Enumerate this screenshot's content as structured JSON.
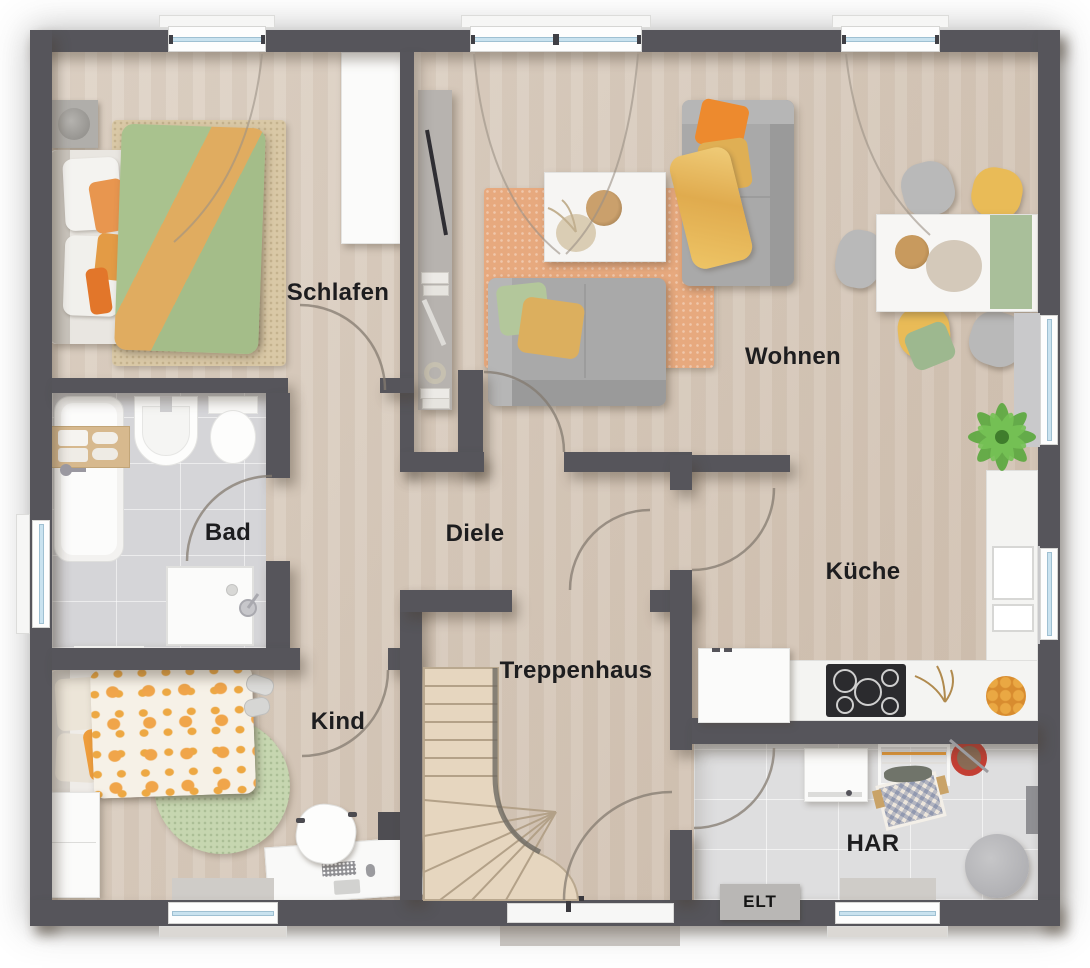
{
  "rooms": [
    {
      "id": "schlafen",
      "label": "Schlafen"
    },
    {
      "id": "wohnen",
      "label": "Wohnen"
    },
    {
      "id": "bad",
      "label": "Bad"
    },
    {
      "id": "diele",
      "label": "Diele"
    },
    {
      "id": "kueche",
      "label": "Küche"
    },
    {
      "id": "kind",
      "label": "Kind"
    },
    {
      "id": "treppenhaus",
      "label": "Treppenhaus"
    },
    {
      "id": "har",
      "label": "HAR"
    }
  ],
  "annotations": {
    "elt": "ELT"
  },
  "colors": {
    "wall": "#56555b",
    "wood_floor": "#d8cabb",
    "tile_floor": "#d5d5d8",
    "window_glass": "#c9e2ef",
    "accent_orange": "#e8964f",
    "accent_green": "#a9c290",
    "accent_yellow": "#e9bb57"
  }
}
